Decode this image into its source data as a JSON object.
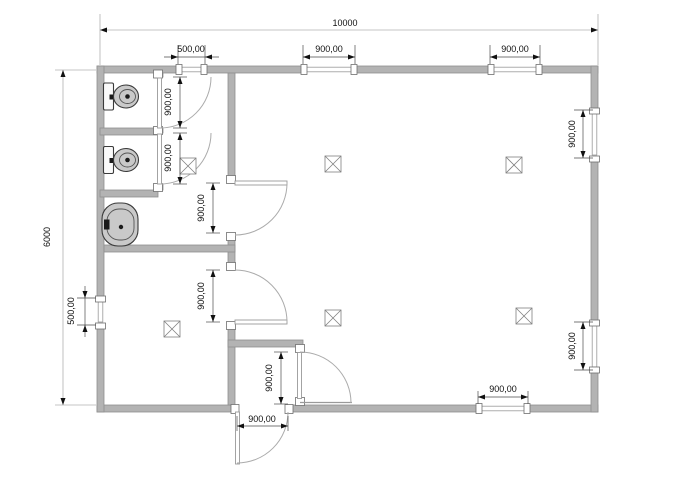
{
  "drawing": {
    "kind": "architectural floor plan",
    "colors": {
      "background": "#ffffff",
      "wall_fill": "#b3b3b3",
      "wall_stroke": "#8f8f8f",
      "dim_line": "#4a4a4a",
      "dim_line_light": "#b0b0b0",
      "arc_line": "#ababab",
      "fixture_fill": "#c9c9c9",
      "text": "#111111"
    }
  },
  "dimensions": {
    "overall_width": "10000",
    "overall_height": "6000",
    "top_left_window": "500,00",
    "top_center_window": "900,00",
    "top_right_window": "900,00",
    "right_upper_window": "900,00",
    "right_lower_window": "900,00",
    "left_window": "500,00",
    "bottom_window": "900,00",
    "stall1_door": "900,00",
    "stall2_door": "900,00",
    "wc_entry_door": "900,00",
    "inner_room_door": "900,00",
    "lobby_door": "900,00",
    "exterior_door": "900,00"
  }
}
